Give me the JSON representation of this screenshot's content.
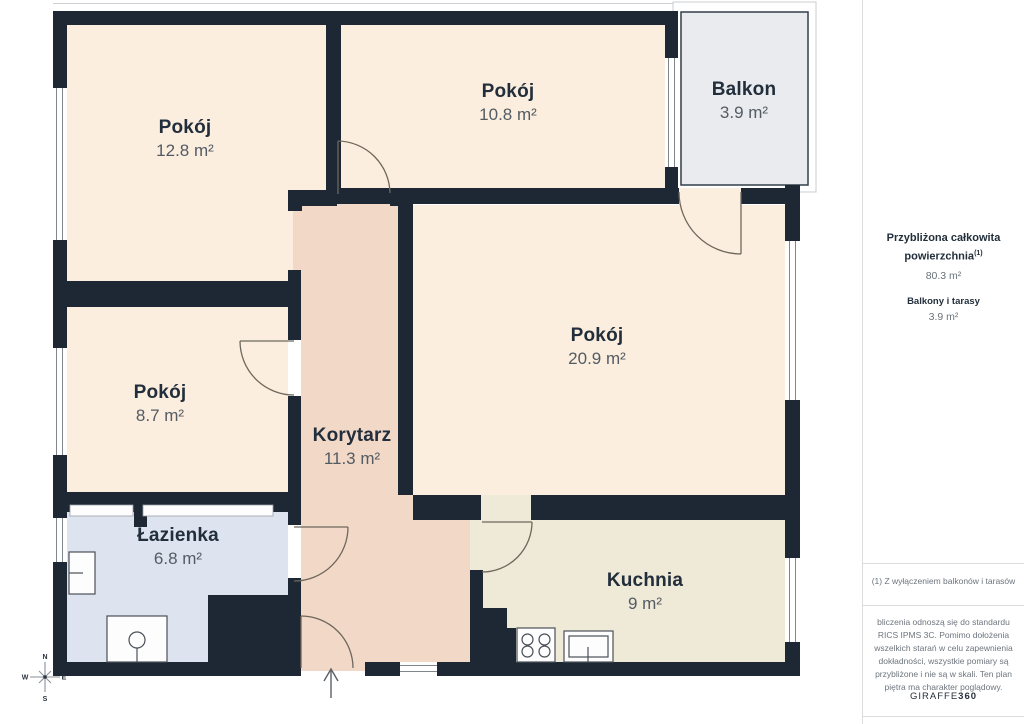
{
  "floor_plan": {
    "rooms": [
      {
        "name": "Pokój",
        "area": "12.8 m²"
      },
      {
        "name": "Pokój",
        "area": "10.8 m²"
      },
      {
        "name": "Balkon",
        "area": "3.9 m²"
      },
      {
        "name": "Pokój",
        "area": "20.9 m²"
      },
      {
        "name": "Pokój",
        "area": "8.7 m²"
      },
      {
        "name": "Korytarz",
        "area": "11.3 m²"
      },
      {
        "name": "Łazienka",
        "area": "6.8 m²"
      },
      {
        "name": "Kuchnia",
        "area": "9 m²"
      }
    ],
    "compass": {
      "north": "N",
      "east": "E",
      "south": "S",
      "west": "W"
    }
  },
  "sidebar": {
    "total_area_label_line1": "Przybliżona całkowita",
    "total_area_label_line2": "powierzchnia",
    "total_area_footnote_marker": "(1)",
    "total_area_value": "80.3 m²",
    "balconies_label": "Balkony i tarasy",
    "balconies_value": "3.9 m²",
    "footnote": "(1) Z wyłączeniem balkonów i tarasów",
    "disclaimer": "bliczenia odnoszą się do standardu RICS IPMS 3C. Pomimo dołożenia wszelkich starań w celu zapewnienia dokładności, wszystkie pomiary są przybliżone i nie są w skali. Ten plan piętra ma charakter poglądowy.",
    "brand_name": "GIRAFFE",
    "brand_suffix": "360"
  },
  "colors": {
    "wall": "#1d2834",
    "room": "#fbeede",
    "corridor": "#f2d8c6",
    "kitchen": "#efe9d7",
    "bathroom": "#dde4ef",
    "balcony": "#e9ebee",
    "background": "#ffffff"
  }
}
